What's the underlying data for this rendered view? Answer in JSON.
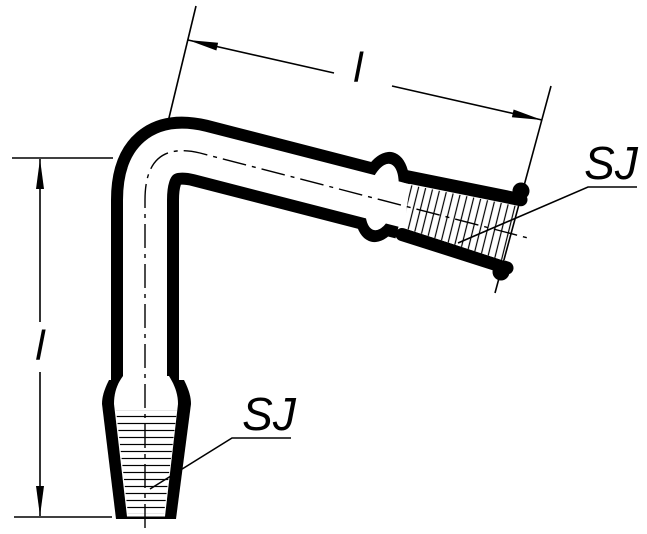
{
  "colors": {
    "ink": "#000000",
    "paper": "#ffffff"
  },
  "labels": {
    "top_dimension": "l",
    "left_dimension": "l",
    "top_joint": "SJ",
    "bottom_joint": "SJ"
  }
}
